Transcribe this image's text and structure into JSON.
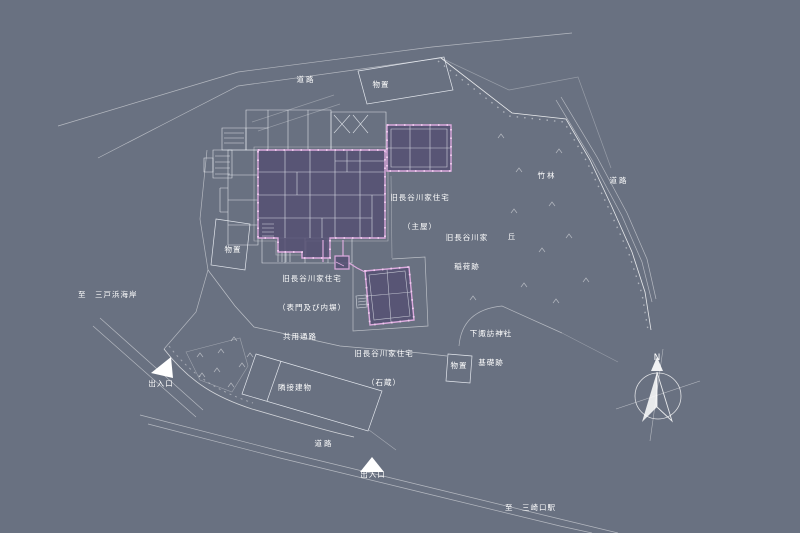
{
  "colors": {
    "background": "#697181",
    "line_strong": "#eef1f6",
    "line_faint": "#aeb6c4",
    "highlight_stroke": "#dcaade",
    "highlight_dots": "#f2cdf0",
    "highlight_fill": "#5e5b76",
    "text": "#ffffff"
  },
  "labels": {
    "road_top": "道路",
    "road_right": "道路",
    "road_bottom": "道路",
    "shed_top": "物置",
    "shed_left": "物置",
    "shed_east": "物置",
    "bamboo_grove": "竹林",
    "hill": "丘",
    "main_house_l1": "旧長谷川家住宅",
    "main_house_l2": "（主屋）",
    "inari_l1": "旧長谷川家",
    "inari_l2": "稲荷跡",
    "gate_l1": "旧長谷川家住宅",
    "gate_l2": "（表門及び内塀）",
    "storehouse_l1": "旧長谷川家住宅",
    "storehouse_l2": "（石蔵）",
    "shrine_l1": "下諏訪神社",
    "shrine_l2": "基礎跡",
    "shared_passage": "共用通路",
    "adjacent_building": "隣接建物",
    "entrance_west": "出入口",
    "entrance_south": "出入口",
    "to_mitohama": "至　三戸浜海岸",
    "to_misakiguchi": "至　三崎口駅"
  },
  "compass": {
    "north": "N"
  }
}
